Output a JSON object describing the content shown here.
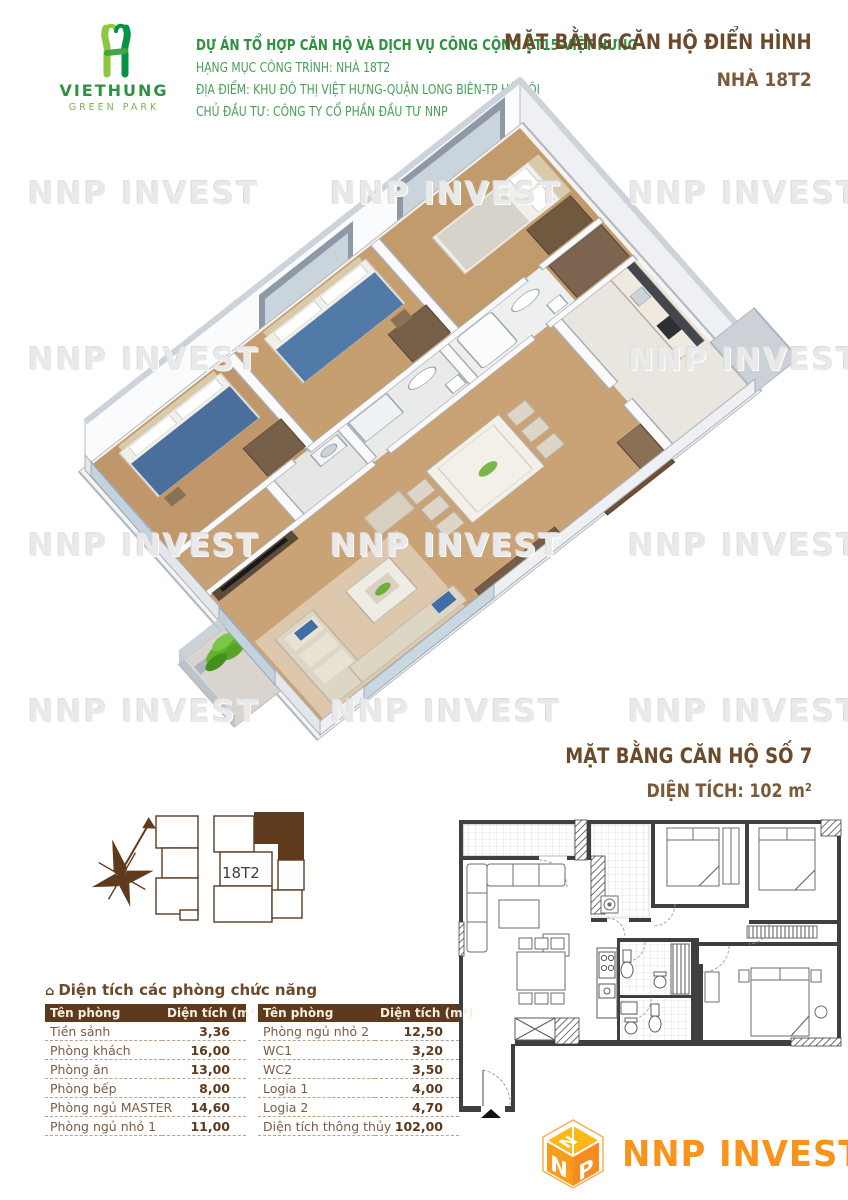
{
  "watermark": "NNP INVEST",
  "header": {
    "logo": {
      "name": "VIETHUNG",
      "sub": "GREEN PARK"
    },
    "lines": {
      "l1": "DỰ ÁN TỔ HỢP CĂN HỘ VÀ DỊCH VỤ CÔNG CỘNG CT15-VIỆT HƯNG",
      "l2": "HẠNG MỤC CÔNG TRÌNH: NHÀ 18T2",
      "l3": "ĐỊA ĐIỂM: KHU ĐÔ THỊ VIỆT HƯNG-QUẬN LONG BIÊN-TP HÀ NỘI",
      "l4": "CHỦ ĐẦU TƯ: CÔNG TY CỔ PHẦN ĐẦU TƯ NNP"
    },
    "title": "MẶT BẰNG CĂN HỘ ĐIỂN HÌNH",
    "subtitle": "NHÀ 18T2"
  },
  "unit_section": {
    "title": "MẶT BẰNG CĂN HỘ SỐ 7",
    "area": "DIỆN TÍCH: 102 m²"
  },
  "keyplan": {
    "compass": "B",
    "label": "18T2"
  },
  "area_table": {
    "icon": "⌂",
    "title": "Diện tích các phòng chức năng",
    "col_name": "Tên phòng",
    "col_area": "Diện tích (m²)",
    "left": [
      {
        "name": "Tiền sảnh",
        "area": "3,36"
      },
      {
        "name": "Phòng khách",
        "area": "16,00"
      },
      {
        "name": "Phòng ăn",
        "area": "13,00"
      },
      {
        "name": "Phòng bếp",
        "area": "8,00"
      },
      {
        "name": "Phòng ngủ MASTER",
        "area": "14,60"
      },
      {
        "name": "Phòng ngủ nhỏ 1",
        "area": "11,00"
      }
    ],
    "right": [
      {
        "name": "Phòng ngủ nhỏ 2",
        "area": "12,50"
      },
      {
        "name": "WC1",
        "area": "3,20"
      },
      {
        "name": "WC2",
        "area": "3,50"
      },
      {
        "name": "Logia 1",
        "area": "4,00"
      },
      {
        "name": "Logia 2",
        "area": "4,70"
      },
      {
        "name": "Diện tích thông thủy",
        "area": "102,00"
      }
    ]
  },
  "footer_logo": {
    "text": "NNP INVEST",
    "cube": [
      "N",
      "N",
      "P"
    ]
  },
  "colors": {
    "green": "#2f9242",
    "green_light": "#47a058",
    "brown": "#6b4a2c",
    "table_header": "#5d3a1d",
    "orange": "#f7941e"
  }
}
